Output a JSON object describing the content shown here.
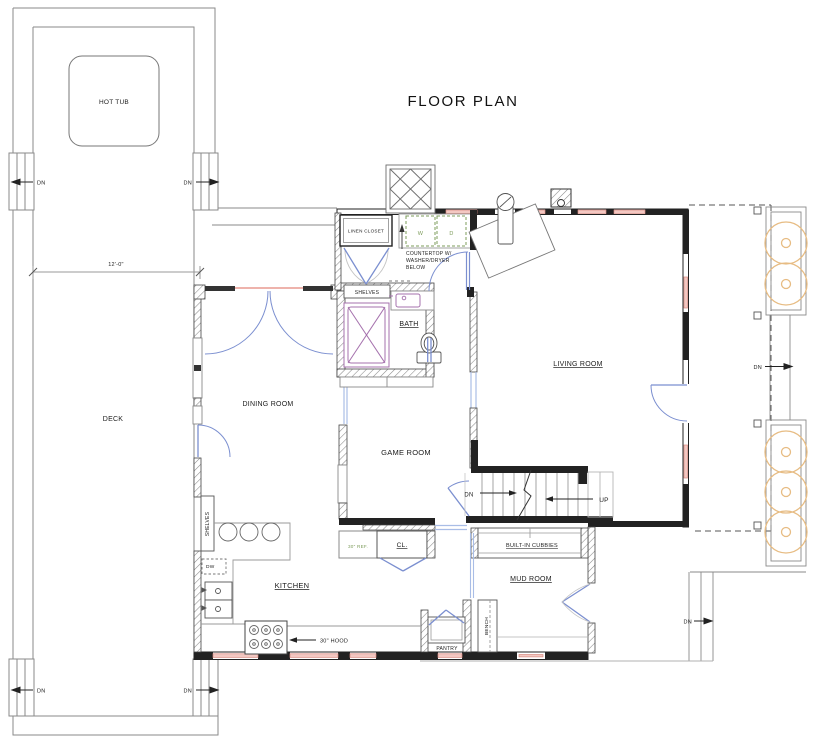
{
  "title": "FLOOR PLAN",
  "rooms": {
    "hot_tub": "HOT TUB",
    "deck": "DECK",
    "dining": "DINING ROOM",
    "living": "LIVING ROOM",
    "game": "GAME ROOM",
    "kitchen": "KITCHEN",
    "bath": "BATH",
    "mud": "MUD ROOM",
    "pantry": "PANTRY",
    "linen": "LINEN CLOSET",
    "closet": "CL."
  },
  "labels": {
    "dn": "DN",
    "up": "UP",
    "deck_dim": "12'-0\"",
    "shelves": "SHELVES",
    "dw": "DW",
    "washer": "W",
    "dryer": "D",
    "countertop_note_line1": "COUNTERTOP W/",
    "countertop_note_line2": "WASHER/DRYER",
    "countertop_note_line3": "BELOW",
    "ref": "30\" REF.",
    "hood": "30\" HOOD",
    "cubbies": "BUILT-IN CUBBIES",
    "bench": "BENCH"
  },
  "colors": {
    "wall": "#222222",
    "thin_line": "#8a8a8a",
    "door_blue": "#7b8fd0",
    "trim_blue": "#a9bde6",
    "window_pink": "#e89a90",
    "appliance_green": "#7d9c5b",
    "landscape_orange": "#e7bc83",
    "fixture_purple": "#a571ad"
  }
}
